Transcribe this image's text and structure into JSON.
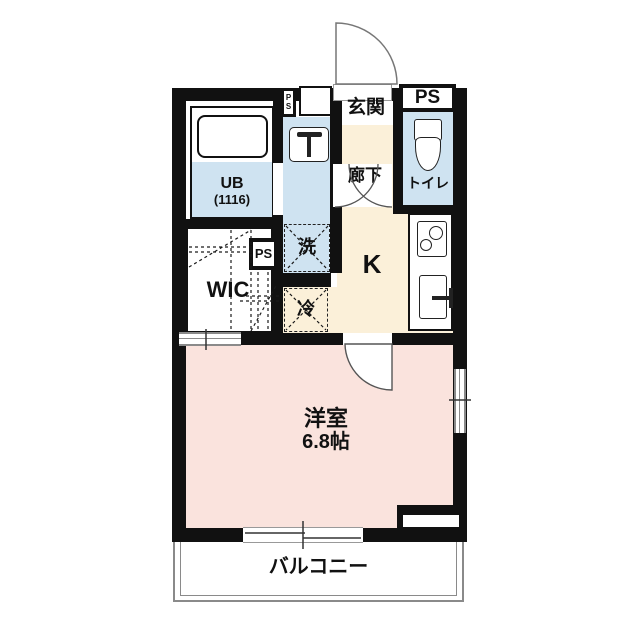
{
  "floorplan": {
    "rooms": {
      "genkan": {
        "label": "玄関"
      },
      "hallway": {
        "label": "廊下"
      },
      "toilet": {
        "label": "トイレ"
      },
      "kitchen": {
        "label": "K"
      },
      "ub": {
        "label": "UB",
        "size_label": "(1116)"
      },
      "washer": {
        "label": "洗"
      },
      "fridge": {
        "label": "冷"
      },
      "wic": {
        "label": "WIC"
      },
      "main_room": {
        "label": "洋室",
        "size_label": "6.8帖"
      },
      "balcony": {
        "label": "バルコニー"
      },
      "ps_top_right": {
        "label": "PS"
      },
      "ps_mid": {
        "label": "PS"
      },
      "ps_shaft": {
        "line1": "P",
        "line2": "S"
      }
    },
    "colors": {
      "wall": "#111111",
      "water_blue": "#cfe3f1",
      "kitchen_cream": "#fbf0d9",
      "room_pink": "#fae3dd",
      "line_gray": "#8a8a8a"
    }
  }
}
